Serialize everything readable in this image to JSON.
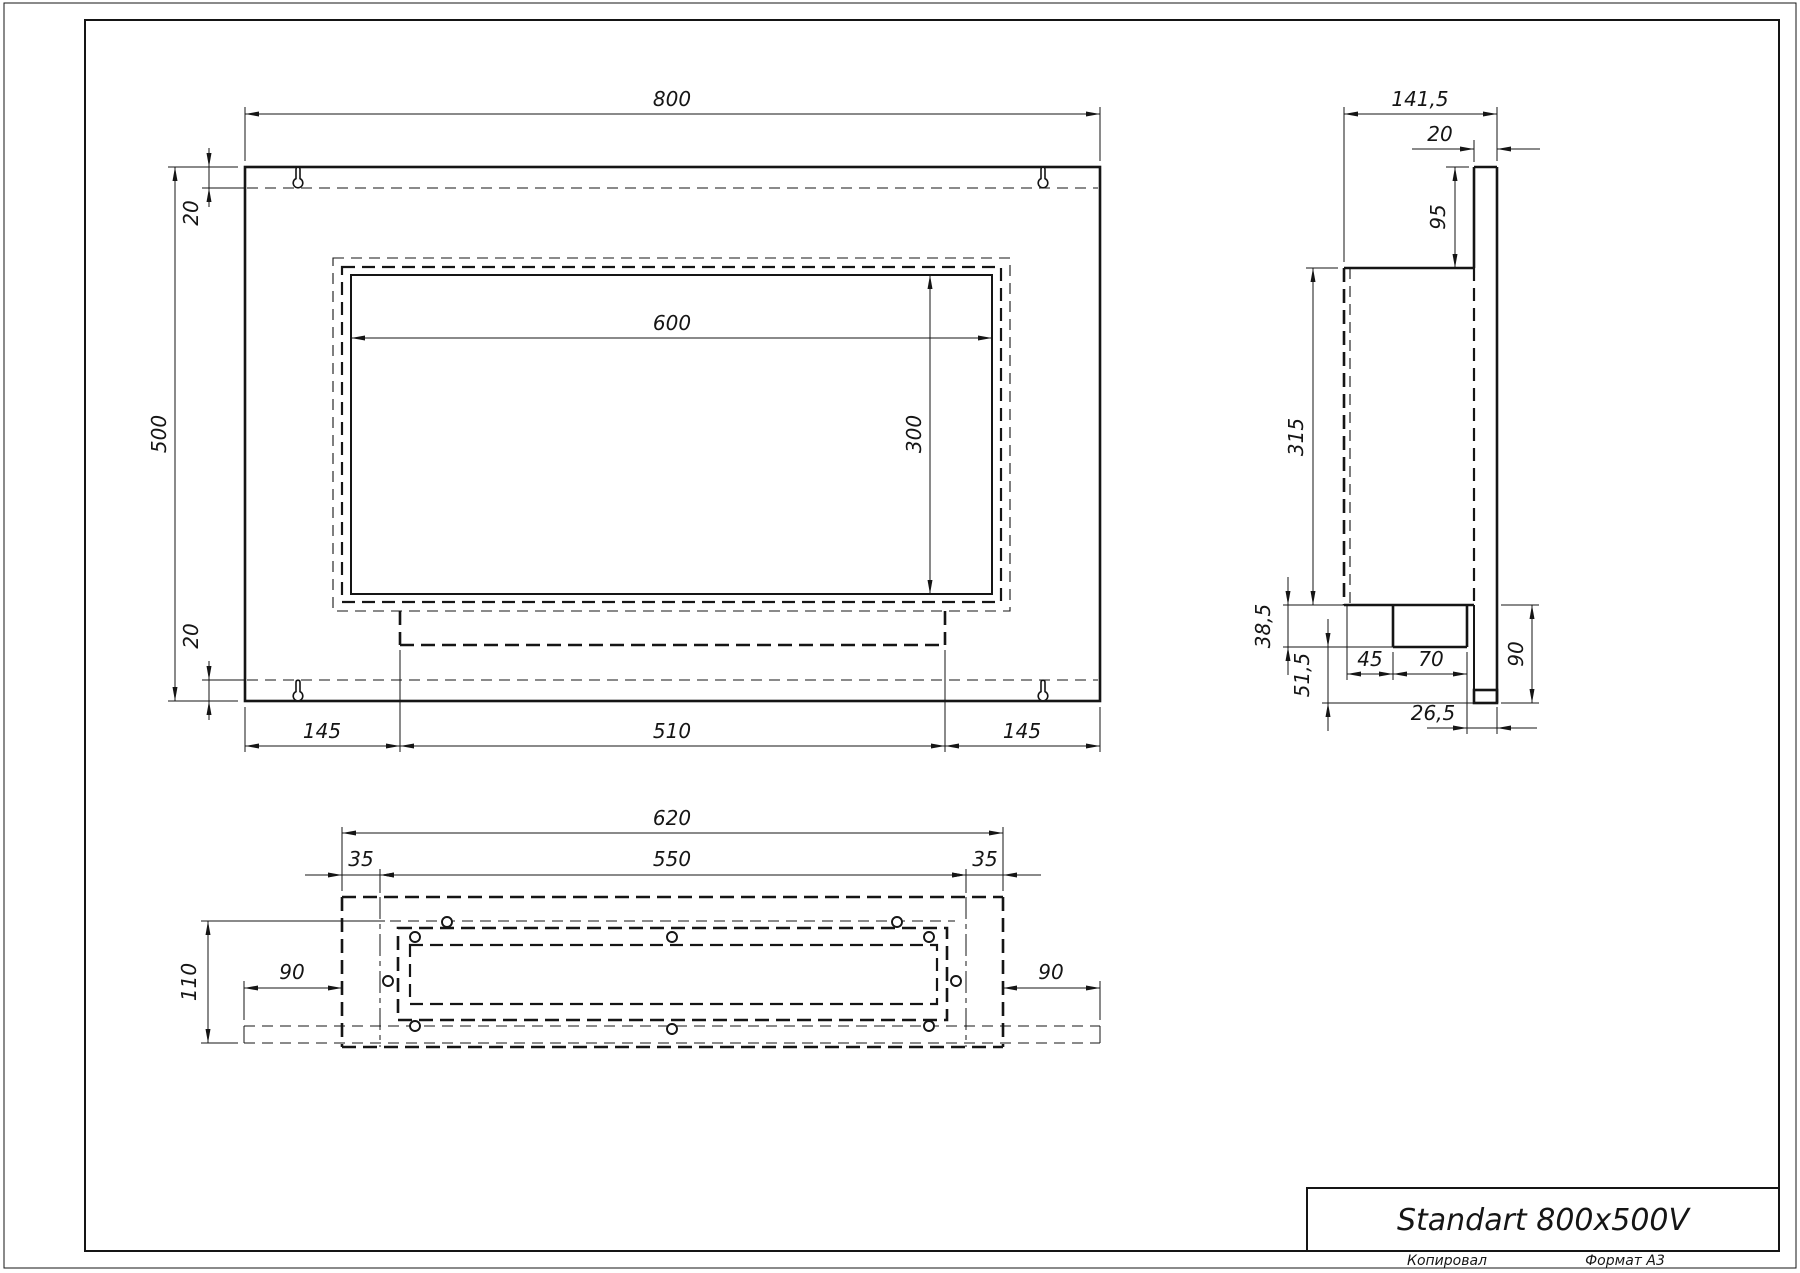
{
  "title_block": {
    "title": "Standart 800x500V",
    "copied_label": "Копировал",
    "format_label": "Формат А3"
  },
  "front_view": {
    "dim_width": "800",
    "dim_height": "500",
    "dim_flange_top": "20",
    "dim_flange_bottom": "20",
    "dim_opening_width": "600",
    "dim_opening_height": "300",
    "dim_left_offset": "145",
    "dim_burner_width": "510",
    "dim_right_offset": "145"
  },
  "side_view": {
    "dim_total_depth": "141,5",
    "dim_panel_thickness": "20",
    "dim_top_offset": "95",
    "dim_body_height": "315",
    "dim_tray_height": "38,5",
    "dim_bottom_offset": "51,5",
    "dim_front_gap": "45",
    "dim_burner_depth": "70",
    "dim_lower_height": "90",
    "dim_rear_gap": "26,5"
  },
  "bottom_view": {
    "dim_box_width": "620",
    "dim_inner_width": "550",
    "dim_fold_left": "35",
    "dim_fold_right": "35",
    "dim_depth": "110",
    "dim_flange_left": "90",
    "dim_flange_right": "90"
  }
}
